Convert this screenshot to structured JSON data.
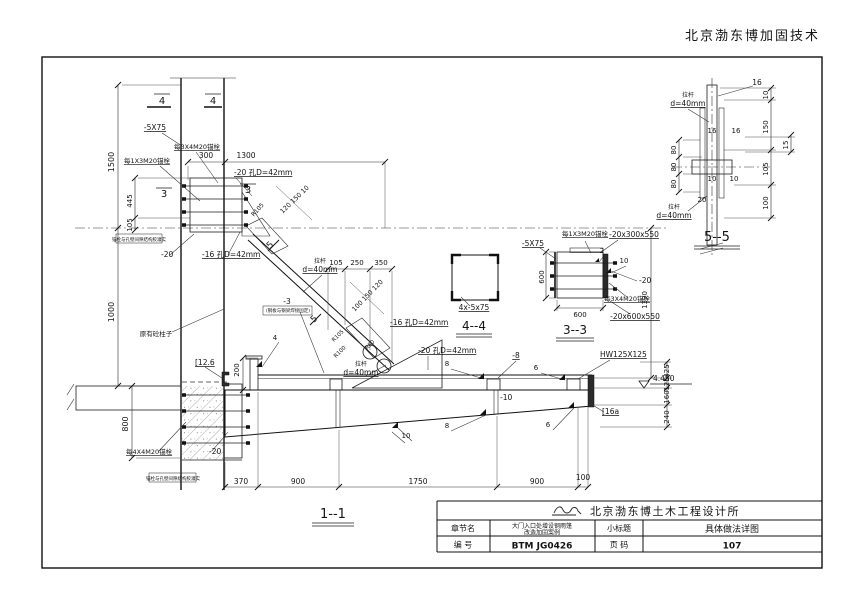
{
  "page": {
    "header": "北京渤东博加固技术"
  },
  "title_block": {
    "company": "北京渤东博土木工程设计所",
    "chapter_label": "章节名",
    "chapter_value_line1": "大门入口处增设钢雨篷",
    "chapter_value_line2": "改造加固案例",
    "subtitle_label": "小标题",
    "subtitle_value": "具体做法详图",
    "number_label": "编  号",
    "number_value": "BTM JG0426",
    "pagecode_label": "页  码",
    "pagecode_value": "107",
    "logo_icon": "company-logo-icon"
  },
  "drawing": {
    "section_titles": [
      "1--1",
      "3--3",
      "4--4",
      "5--5"
    ],
    "labels": [
      {
        "t": "4",
        "x": 162,
        "y": 104,
        "s": 10,
        "n": "section-mark-4"
      },
      {
        "t": "4",
        "x": 213,
        "y": 104,
        "s": 10,
        "n": "section-mark-4"
      },
      {
        "t": "-5X75",
        "x": 155,
        "y": 130,
        "u": 1,
        "s": 7.5
      },
      {
        "t": "1500",
        "x": 114,
        "y": 162,
        "r": -90
      },
      {
        "t": "每3X4M20锚栓",
        "x": 197,
        "y": 149,
        "s": 6.5,
        "u": 1
      },
      {
        "t": "每1X3M20锚栓",
        "x": 147,
        "y": 163,
        "s": 6.5,
        "u": 1
      },
      {
        "t": "300",
        "x": 206,
        "y": 158,
        "s": 7.5
      },
      {
        "t": "1300",
        "x": 246,
        "y": 158,
        "s": 7.5
      },
      {
        "t": "-20 孔D=42mm",
        "x": 234,
        "y": 175,
        "a": "s",
        "u": 1,
        "s": 7.5
      },
      {
        "t": "3",
        "x": 164,
        "y": 197,
        "s": 10,
        "n": "section-mark-3"
      },
      {
        "t": "3",
        "x": 248,
        "y": 193,
        "s": 10,
        "n": "section-mark-3"
      },
      {
        "t": "445",
        "x": 132,
        "y": 201,
        "r": -90,
        "s": 7
      },
      {
        "t": "105",
        "x": 132,
        "y": 225,
        "r": -90,
        "s": 7
      },
      {
        "t": "1000",
        "x": 114,
        "y": 312,
        "r": -90
      },
      {
        "t": "锚栓与孔壁间隙结构胶灌实",
        "x": 139,
        "y": 241,
        "s": 4.5
      },
      {
        "t": "-20",
        "x": 161,
        "y": 257,
        "a": "s",
        "s": 7.5
      },
      {
        "t": "-16 孔D=42mm",
        "x": 202,
        "y": 257,
        "a": "s",
        "u": 1,
        "s": 7.5
      },
      {
        "t": "R105",
        "x": 259,
        "y": 211,
        "r": -48,
        "s": 6
      },
      {
        "t": "120 150 10",
        "x": 296,
        "y": 201,
        "r": -44,
        "s": 6.5
      },
      {
        "t": "5",
        "x": 272,
        "y": 247,
        "r": -45,
        "s": 9,
        "n": "section-mark-5"
      },
      {
        "t": "拉杆",
        "x": 320,
        "y": 263,
        "s": 6
      },
      {
        "t": "d=40mm",
        "x": 320,
        "y": 272,
        "u": 1,
        "s": 7.5
      },
      {
        "t": "105",
        "x": 336,
        "y": 265,
        "s": 7
      },
      {
        "t": "250",
        "x": 357,
        "y": 265,
        "s": 7
      },
      {
        "t": "350",
        "x": 381,
        "y": 265,
        "s": 7
      },
      {
        "t": "100 150 120",
        "x": 369,
        "y": 297,
        "r": -46,
        "s": 6.5
      },
      {
        "t": "5",
        "x": 316,
        "y": 321,
        "r": -45,
        "s": 9,
        "n": "section-mark-5"
      },
      {
        "t": "-16 孔D=42mm",
        "x": 390,
        "y": 325,
        "a": "s",
        "u": 1,
        "s": 7.5
      },
      {
        "t": "R105",
        "x": 339,
        "y": 337,
        "r": -45,
        "s": 5.5
      },
      {
        "t": "R100",
        "x": 341,
        "y": 353,
        "r": -45,
        "s": 5.5
      },
      {
        "t": "R80",
        "x": 371,
        "y": 346,
        "r": -45,
        "s": 5.5
      },
      {
        "t": "-20 孔D=42mm",
        "x": 418,
        "y": 353,
        "a": "s",
        "u": 1,
        "s": 7.5
      },
      {
        "t": "拉杆",
        "x": 361,
        "y": 366,
        "s": 6
      },
      {
        "t": "d=40mm",
        "x": 361,
        "y": 375,
        "u": 1,
        "s": 7.5
      },
      {
        "t": "4x-5x75",
        "x": 474,
        "y": 310,
        "u": 1,
        "s": 7.5
      },
      {
        "t": "4--4",
        "x": 474,
        "y": 330,
        "s": 12,
        "n": "title-4-4"
      },
      {
        "t": "-5X75",
        "x": 533,
        "y": 246,
        "u": 1,
        "s": 7.5
      },
      {
        "t": "每1X3M20锚栓",
        "x": 585,
        "y": 236,
        "s": 6.5,
        "u": 1
      },
      {
        "t": "-20x300x550",
        "x": 634,
        "y": 237,
        "u": 1,
        "s": 7.5
      },
      {
        "t": "2",
        "x": 602,
        "y": 253,
        "s": 7
      },
      {
        "t": "10",
        "x": 624,
        "y": 263,
        "s": 7
      },
      {
        "t": "-20",
        "x": 639,
        "y": 283,
        "a": "s",
        "s": 7.5
      },
      {
        "t": "每3X4M20锚栓",
        "x": 627,
        "y": 301,
        "s": 6.5,
        "u": 1
      },
      {
        "t": "-20x600x550",
        "x": 635,
        "y": 319,
        "u": 1,
        "s": 7.5
      },
      {
        "t": "600",
        "x": 544,
        "y": 277,
        "r": -90,
        "s": 7
      },
      {
        "t": "600",
        "x": 580,
        "y": 317,
        "s": 7
      },
      {
        "t": "3--3",
        "x": 575,
        "y": 334,
        "s": 12,
        "n": "title-3-3"
      },
      {
        "t": "1390",
        "x": 647,
        "y": 300,
        "r": -90,
        "s": 7
      },
      {
        "t": "拉杆",
        "x": 688,
        "y": 97,
        "s": 6
      },
      {
        "t": "d=40mm",
        "x": 688,
        "y": 106,
        "u": 1,
        "s": 7.5
      },
      {
        "t": "16",
        "x": 757,
        "y": 85,
        "s": 7.5
      },
      {
        "t": "10",
        "x": 768,
        "y": 95,
        "r": -90,
        "s": 7
      },
      {
        "t": "150",
        "x": 768,
        "y": 127,
        "r": -90,
        "s": 7
      },
      {
        "t": "15",
        "x": 788,
        "y": 145,
        "r": -90,
        "s": 7
      },
      {
        "t": "105",
        "x": 768,
        "y": 169,
        "r": -90,
        "s": 7
      },
      {
        "t": "100",
        "x": 768,
        "y": 203,
        "r": -90,
        "s": 7
      },
      {
        "t": "80",
        "x": 676,
        "y": 150,
        "r": -90,
        "s": 7
      },
      {
        "t": "80",
        "x": 676,
        "y": 167,
        "r": -90,
        "s": 7
      },
      {
        "t": "80",
        "x": 676,
        "y": 184,
        "r": -90,
        "s": 7
      },
      {
        "t": "16",
        "x": 712,
        "y": 133,
        "s": 7
      },
      {
        "t": "16",
        "x": 736,
        "y": 133,
        "s": 7
      },
      {
        "t": "10",
        "x": 712,
        "y": 181,
        "s": 7
      },
      {
        "t": "10",
        "x": 734,
        "y": 181,
        "s": 7
      },
      {
        "t": "20",
        "x": 702,
        "y": 202,
        "s": 7
      },
      {
        "t": "拉杆",
        "x": 674,
        "y": 209,
        "s": 6
      },
      {
        "t": "d=40mm",
        "x": 674,
        "y": 218,
        "u": 1,
        "s": 7.5
      },
      {
        "t": "5--5",
        "x": 717,
        "y": 241,
        "s": 13,
        "n": "title-5-5"
      },
      {
        "t": "原有砼柱子",
        "x": 156,
        "y": 336,
        "s": 6.5
      },
      {
        "t": "[12.6",
        "x": 195,
        "y": 365,
        "a": "s",
        "u": 1,
        "s": 7.5
      },
      {
        "t": "200",
        "x": 239,
        "y": 370,
        "r": -90,
        "s": 7
      },
      {
        "t": "4",
        "x": 275,
        "y": 340,
        "s": 7
      },
      {
        "t": "-3",
        "x": 287,
        "y": 304,
        "s": 7.5
      },
      {
        "t": "(钢板与钢梁焊接固定)",
        "x": 288,
        "y": 312,
        "s": 4.5
      },
      {
        "t": "8",
        "x": 447,
        "y": 366,
        "s": 7
      },
      {
        "t": "-8",
        "x": 516,
        "y": 358,
        "u": 1,
        "s": 7.5
      },
      {
        "t": "6",
        "x": 536,
        "y": 370,
        "s": 7
      },
      {
        "t": "HW125X125",
        "x": 600,
        "y": 357,
        "a": "s",
        "u": 1,
        "s": 7.5
      },
      {
        "t": "-10",
        "x": 500,
        "y": 400,
        "a": "s",
        "s": 7.5
      },
      {
        "t": "[16a",
        "x": 602,
        "y": 414,
        "a": "s",
        "u": 1,
        "s": 7.5
      },
      {
        "t": "8",
        "x": 447,
        "y": 428,
        "s": 7
      },
      {
        "t": "6",
        "x": 548,
        "y": 427,
        "s": 7
      },
      {
        "t": "10",
        "x": 406,
        "y": 438,
        "s": 7
      },
      {
        "t": "每4X4M20锚栓",
        "x": 126,
        "y": 454,
        "a": "s",
        "s": 6.5,
        "u": 1
      },
      {
        "t": "-20",
        "x": 209,
        "y": 454,
        "a": "s",
        "s": 7.5
      },
      {
        "t": "锚栓与孔壁间隙结构胶灌实",
        "x": 173,
        "y": 480,
        "s": 4.5
      },
      {
        "t": "800",
        "x": 128,
        "y": 424,
        "r": -90
      },
      {
        "t": "370",
        "x": 241,
        "y": 484,
        "s": 7.5
      },
      {
        "t": "900",
        "x": 298,
        "y": 484,
        "s": 7.5
      },
      {
        "t": "1750",
        "x": 418,
        "y": 484,
        "s": 7.5
      },
      {
        "t": "900",
        "x": 537,
        "y": 484,
        "s": 7.5
      },
      {
        "t": "100",
        "x": 583,
        "y": 480,
        "s": 7.5
      },
      {
        "t": "4.450",
        "x": 653,
        "y": 381,
        "a": "s",
        "s": 7.5,
        "n": "elevation-value"
      },
      {
        "t": "425",
        "x": 669,
        "y": 371,
        "r": -90,
        "s": 7
      },
      {
        "t": "125",
        "x": 669,
        "y": 384,
        "r": -90,
        "s": 7
      },
      {
        "t": "160",
        "x": 669,
        "y": 397,
        "r": -90,
        "s": 7
      },
      {
        "t": "240",
        "x": 669,
        "y": 417,
        "r": -90,
        "s": 7
      },
      {
        "t": "1--1",
        "x": 333,
        "y": 518,
        "s": 13,
        "n": "title-1-1"
      }
    ]
  }
}
